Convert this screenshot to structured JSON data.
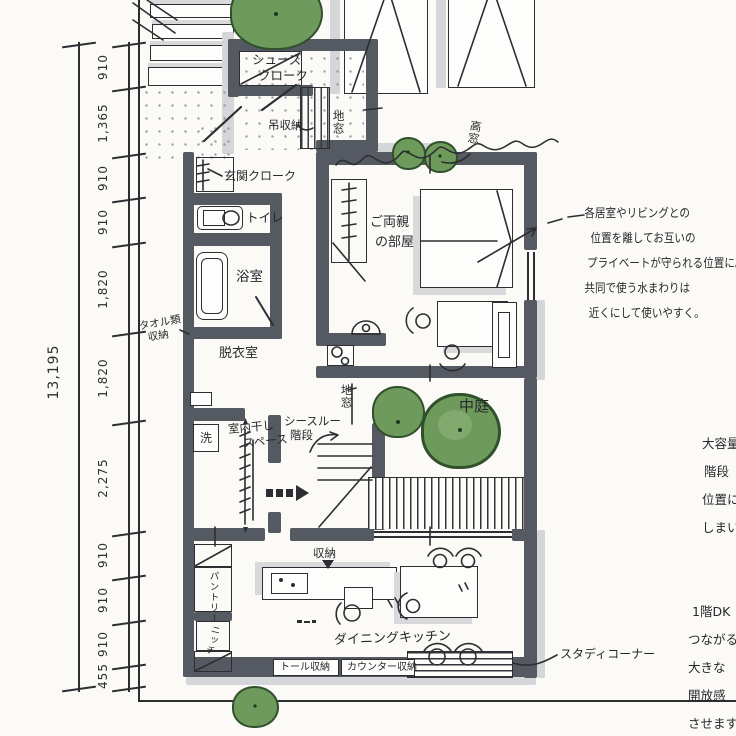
{
  "dimensions": {
    "total": "13,195",
    "segments": [
      "910",
      "1,365",
      "910",
      "910",
      "1,820",
      "1,820",
      "2,275",
      "910",
      "910",
      "910",
      "455"
    ]
  },
  "labels": {
    "shoes_cloak_1": "シューズ",
    "shoes_cloak_2": "クローク",
    "hanging_storage": "吊収納",
    "floor_window_top": "地窓",
    "entrance_cloak": "玄関クローク",
    "toilet": "トイレ",
    "bathroom": "浴室",
    "dressing_room": "脱衣室",
    "towel_storage_1": "タオル類",
    "towel_storage_2": "収納",
    "washer": "洗",
    "indoor_drying_1": "室内干し",
    "indoor_drying_2": "スペース",
    "see_through_stairs_1": "シースルー",
    "see_through_stairs_2": "階段",
    "floor_window_mid": "地窓",
    "parents_room_1": "ご両親",
    "parents_room_2": "の部屋",
    "courtyard": "中庭",
    "high_window": "高窓",
    "storage": "収納",
    "dining_kitchen": "ダイニングキッチン",
    "tall_storage": "トール収納",
    "counter_storage": "カウンター収納",
    "pantry": "パントリー",
    "niche": "ニッチ",
    "study_corner": "スタディコーナー"
  },
  "notes": {
    "privacy": {
      "line1": "各居室やリビングとの",
      "line2": "位置を離してお互いの",
      "line3": "プライベートが守られる位置に。",
      "line4": "共同で使う水まわりは",
      "line5": "近くにして使いやすく。"
    },
    "capacity": {
      "line1": "大容量",
      "line2": "階段",
      "line3": "位置に",
      "line4": "しまい"
    },
    "dk": {
      "line1": "1階DK",
      "line2": "つながる",
      "line3": "大きな",
      "line4": "開放感",
      "line5": "させます"
    }
  },
  "colors": {
    "wall": "#555962",
    "wall_shadow": "#d5d6d9",
    "tree_green": "#6e9a5c",
    "tree_outline": "#31502c",
    "ink": "#2c2e31",
    "paper": "#fbfaf7"
  }
}
